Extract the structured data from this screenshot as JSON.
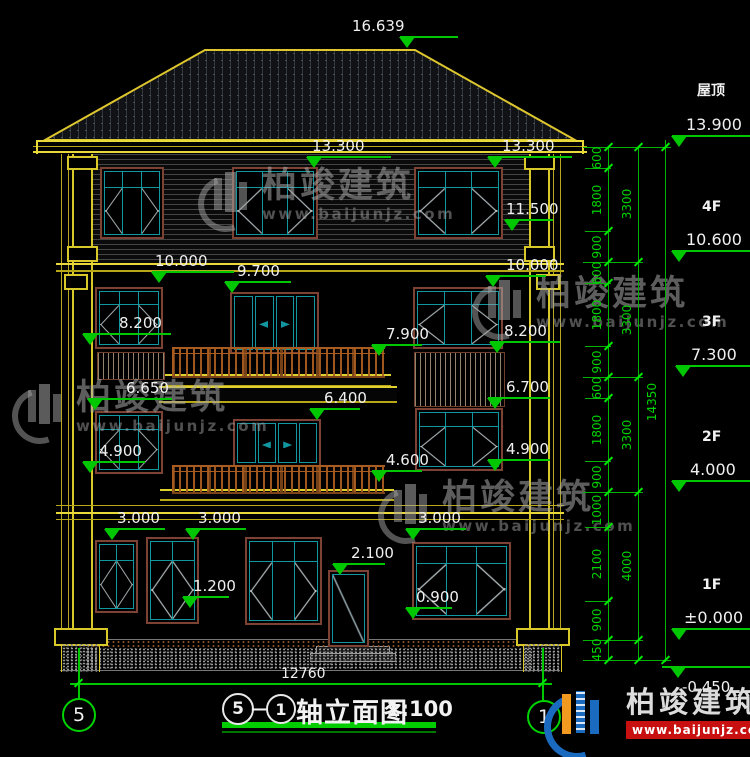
{
  "drawing_type": "architectural-elevation",
  "markers": [
    {
      "v": "16.639"
    },
    {
      "v": "13.300"
    },
    {
      "v": "13.300"
    },
    {
      "v": "11.500"
    },
    {
      "v": "10.000"
    },
    {
      "v": "9.700"
    },
    {
      "v": "10.000"
    },
    {
      "v": "8.200"
    },
    {
      "v": "7.900"
    },
    {
      "v": "8.200"
    },
    {
      "v": "6.650"
    },
    {
      "v": "6.400"
    },
    {
      "v": "6.700"
    },
    {
      "v": "4.900"
    },
    {
      "v": "4.600"
    },
    {
      "v": "4.900"
    },
    {
      "v": "3.000"
    },
    {
      "v": "3.000"
    },
    {
      "v": "3.000"
    },
    {
      "v": "2.100"
    },
    {
      "v": "1.200"
    },
    {
      "v": "0.900"
    }
  ],
  "right_panel": {
    "levels": [
      {
        "label": "屋顶",
        "value": "13.900"
      },
      {
        "label": "4F",
        "value": "10.600"
      },
      {
        "label": "3F",
        "value": "7.300"
      },
      {
        "label": "2F",
        "value": "4.000"
      },
      {
        "label": "1F",
        "value": "±0.000"
      },
      {
        "label": "",
        "value": "-0.450"
      }
    ],
    "chain_inner": [
      "600",
      "1800",
      "900",
      "600",
      "1800",
      "900",
      "600",
      "1800",
      "900",
      "1000",
      "2100",
      "900",
      "450"
    ],
    "chain_mid": [
      "3300",
      "3300",
      "3300",
      "4000"
    ],
    "chain_outer": [
      "14350"
    ]
  },
  "bottom": {
    "overall_width": "12760",
    "axis_left": "5",
    "axis_right": "1"
  },
  "title_block": {
    "axis_from": "5",
    "dash": "—",
    "axis_to": "1",
    "name": "轴立面图",
    "scale": "1:100"
  },
  "watermark": {
    "name": "柏竣建筑",
    "url": "www.baijunjz.com"
  },
  "logo": {
    "name": "柏竣建筑",
    "url": "www.baijunjz.com"
  },
  "colors": {
    "background": "#000000",
    "dimension_green": "#00c800",
    "cad_yellow": "#e8d83a",
    "window_teal": "#1296a0",
    "frame_brown": "#7c4334",
    "railing_brown": "#a85c20",
    "text_white": "#f0f0f0",
    "logo_blue": "#1a6ac0",
    "logo_orange": "#f29a20",
    "logo_red": "#c81010"
  }
}
